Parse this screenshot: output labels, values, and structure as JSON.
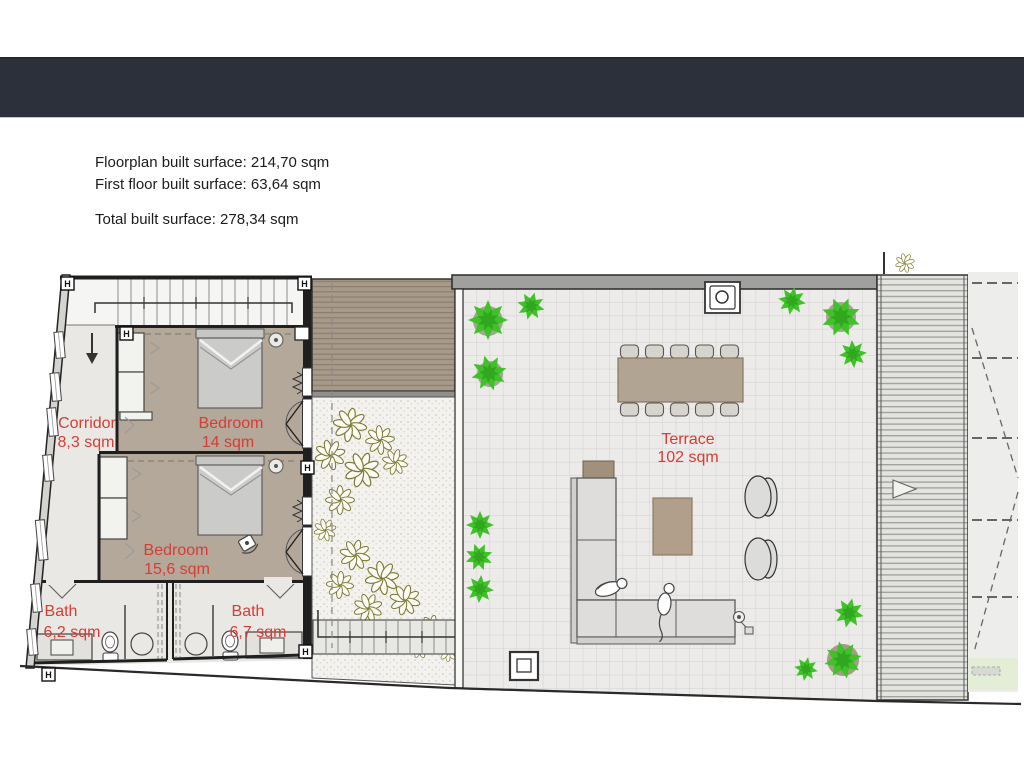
{
  "surface_summary": {
    "floorplan_built": "Floorplan built surface: 214,70 sqm",
    "first_floor_built": "First floor built surface: 63,64 sqm",
    "total_built": "Total built surface: 278,34 sqm"
  },
  "floorplan": {
    "wall_marker": "H",
    "rooms": {
      "corridor": {
        "label": "Corridor",
        "area": "8,3 sqm"
      },
      "bedroom1": {
        "label": "Bedroom",
        "area": "14 sqm"
      },
      "bedroom2": {
        "label": "Bedroom",
        "area": "15,6 sqm"
      },
      "bath1": {
        "label": "Bath",
        "area": "6,2 sqm"
      },
      "bath2": {
        "label": "Bath",
        "area": "6,7 sqm"
      },
      "terrace": {
        "label": "Terrace",
        "area": "102 sqm"
      }
    },
    "colors": {
      "header_bar": "#2b303b",
      "room_label": "#d93c33",
      "bedroom_floor": "#b4a89b",
      "deck_wood": "#a89a8a",
      "bush_green": "#3ec228",
      "terrace_tile": "#ecebe9"
    }
  }
}
